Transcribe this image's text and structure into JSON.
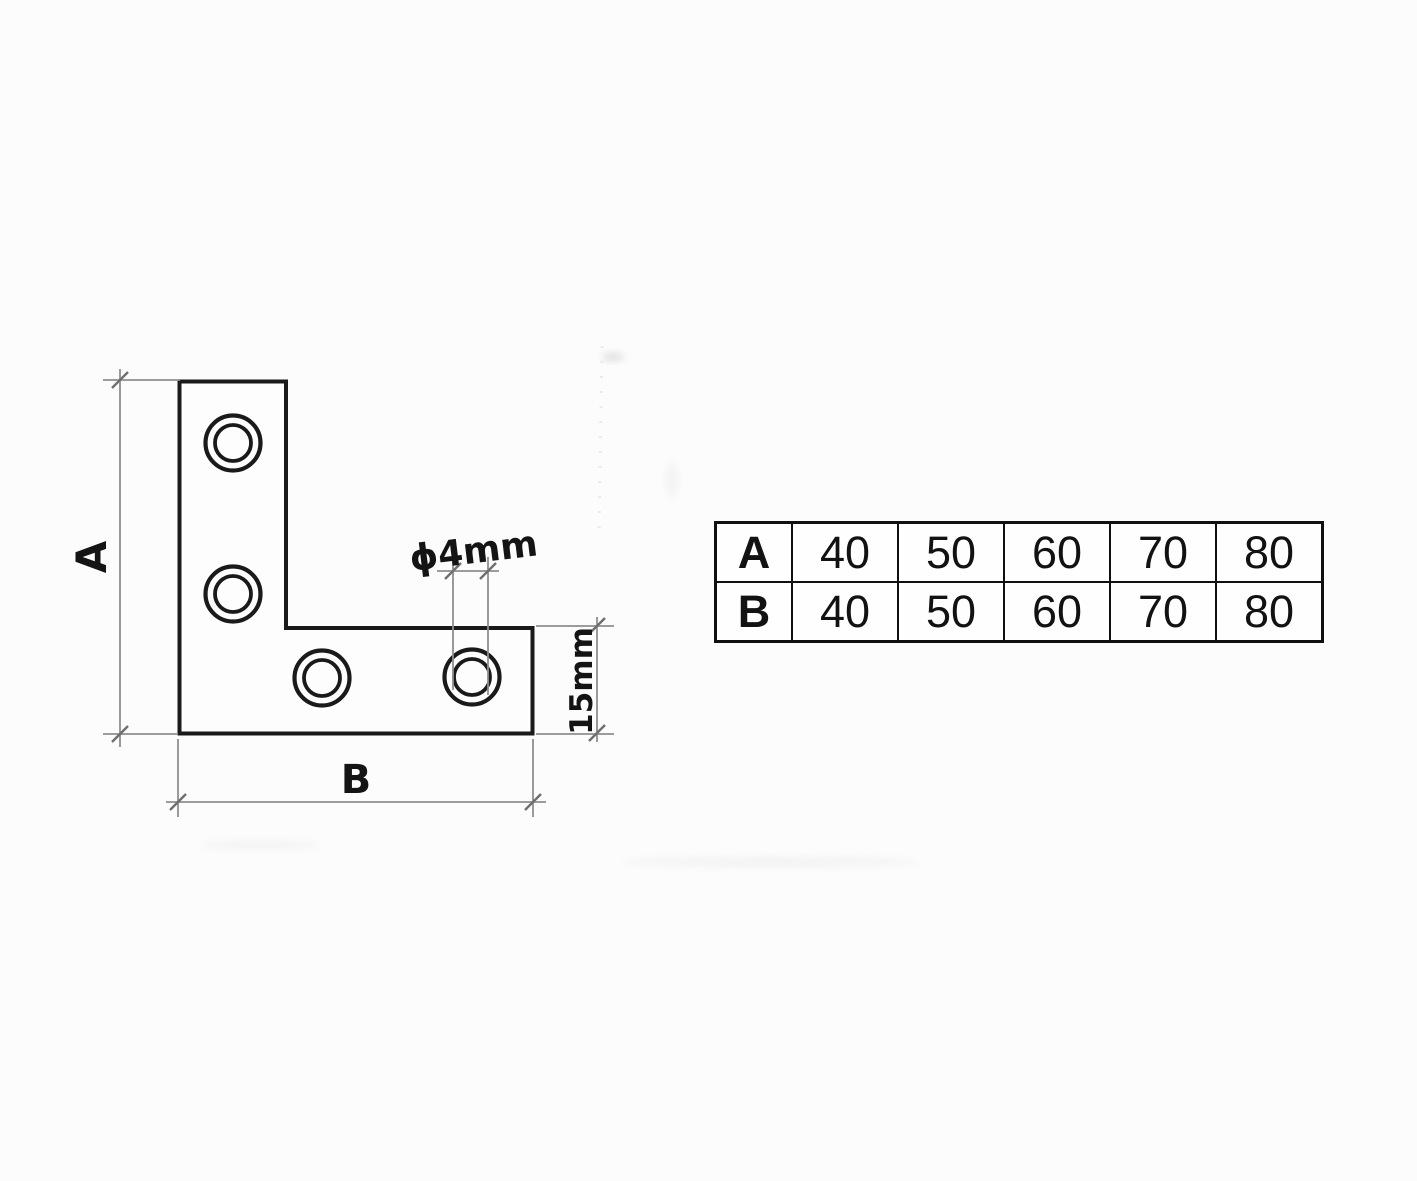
{
  "drawing": {
    "dim_a_label": "A",
    "dim_b_label": "B",
    "hole_diameter_label": "ϕ4mm",
    "leg_width_label": "15mm"
  },
  "table": {
    "rows": [
      {
        "header": "A",
        "values": [
          "40",
          "50",
          "60",
          "70",
          "80"
        ]
      },
      {
        "header": "B",
        "values": [
          "40",
          "50",
          "60",
          "70",
          "80"
        ]
      }
    ]
  },
  "colors": {
    "ink": "#1a1a1a",
    "handwriting": "#141414",
    "dimension_line": "#8f8f8f",
    "table_border": "#101010",
    "paper": "#fcfcfc"
  }
}
